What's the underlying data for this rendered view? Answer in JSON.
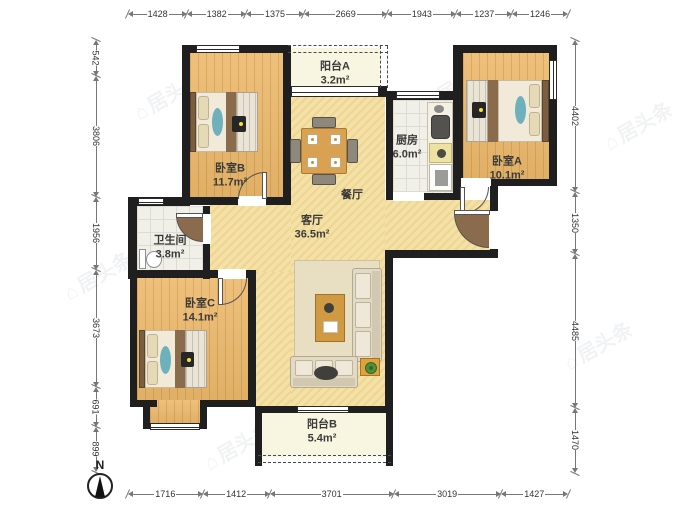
{
  "rooms": [
    {
      "id": "balconyA",
      "name": "阳台A",
      "area": "3.2m²"
    },
    {
      "id": "bedroomB",
      "name": "卧室B",
      "area": "11.7m²"
    },
    {
      "id": "kitchen",
      "name": "厨房",
      "area": "6.0m²"
    },
    {
      "id": "bedroomA",
      "name": "卧室A",
      "area": "10.1m²"
    },
    {
      "id": "dining",
      "name": "餐厅",
      "area": ""
    },
    {
      "id": "living",
      "name": "客厅",
      "area": "36.5m²"
    },
    {
      "id": "bathroom",
      "name": "卫生间",
      "area": "3.8m²"
    },
    {
      "id": "bedroomC",
      "name": "卧室C",
      "area": "14.1m²"
    },
    {
      "id": "balconyB",
      "name": "阳台B",
      "area": "5.4m²"
    }
  ],
  "dimensions": {
    "top": [
      1428,
      1382,
      1375,
      2669,
      1943,
      1237,
      1246
    ],
    "bottom": [
      1716,
      1412,
      3701,
      3019,
      1427
    ],
    "left": [
      542,
      3806,
      1956,
      3673,
      691,
      899
    ],
    "right": [
      4402,
      1350,
      4485,
      1470
    ]
  },
  "compass": {
    "label": "N"
  },
  "watermark": {
    "text": "居头条"
  },
  "icons": {
    "watermark_house": "⌂"
  },
  "colors": {
    "wall": "#1f1f1f",
    "wood_floor": "#ecb96c",
    "living_floor": "#f4e1a6",
    "tile_floor": "#f0efe8",
    "balcony_floor": "#f8f5e0",
    "accent_teal": "#6fb0bd",
    "lamp_yellow": "#f4e23d"
  }
}
